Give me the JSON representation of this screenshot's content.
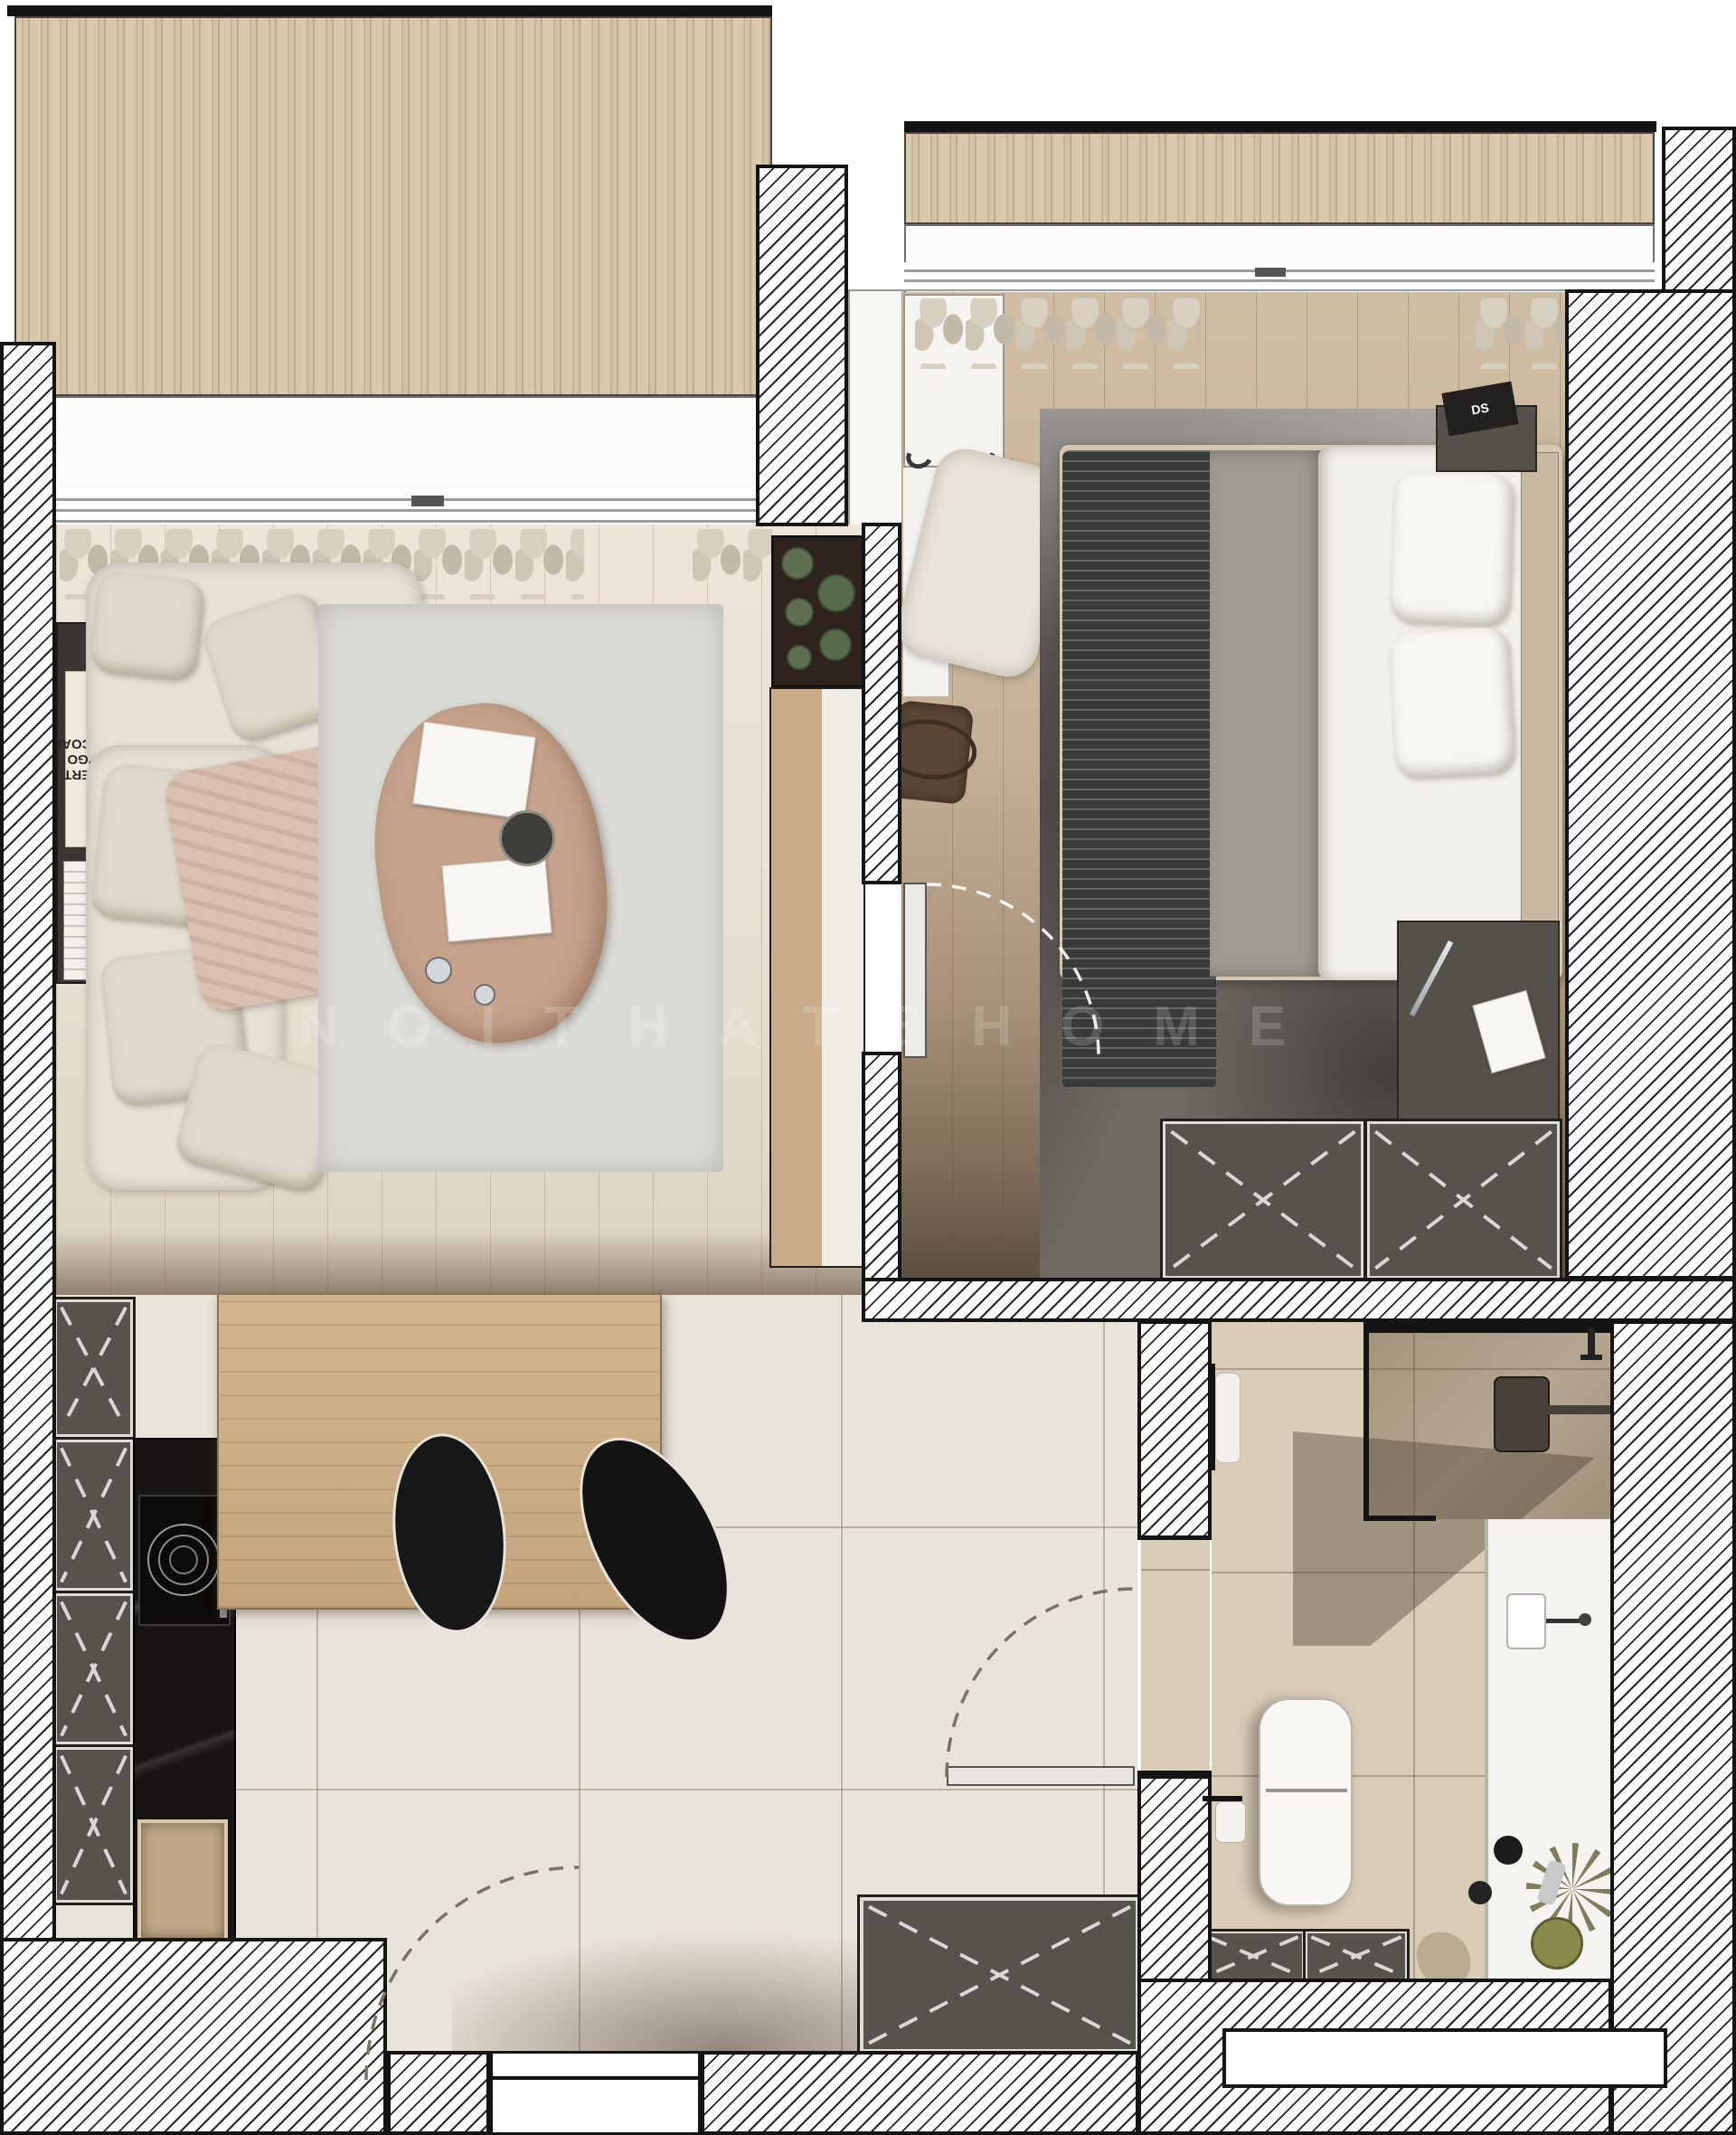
{
  "meta": {
    "type": "floor-plan-render",
    "view": "top-down apartment plan"
  },
  "watermark": {
    "text": "NOITHATSHOME"
  },
  "texts": {
    "book_spine": "ROBERT\nLONGO\nCHARCOAL",
    "nightstand_book": "DS"
  },
  "palette": {
    "wall_hatch_line": "#262626",
    "deck_wood": "#d4c2a7",
    "living_floor": "#e8e1d4",
    "bedroom_floor": "#c4b196",
    "tile_floor": "#e9e4da",
    "bath_tile": "#d9cdb8",
    "cabinet_gray": "#56524c",
    "counter_black": "#181514",
    "table_wood": "#ccae87",
    "sofa_cream": "#e7e0d4",
    "throw_pink": "#d9c0b0",
    "bed_throw_dark": "#3b3e3b",
    "bed_blanket_gray": "#a09c93",
    "bed_sheet_white": "#f2f0ec",
    "rug_living": "#dcdcd7",
    "rug_bedroom": "#6e6962",
    "chair_black": "#171717",
    "cactus_green": "#5f7052"
  },
  "rooms": {
    "balcony": {
      "label": "balcony",
      "items": [
        "wood slat decking",
        "sliding windows"
      ]
    },
    "living_room": {
      "label": "living room",
      "items": [
        "corner sofa",
        "cushions",
        "throw blanket",
        "area rug",
        "coffee table",
        "magazines",
        "coffee cups",
        "wall shelf with books",
        "media cabinet",
        "cactus planter",
        "curtains"
      ]
    },
    "bedroom": {
      "label": "bedroom",
      "items": [
        "double bed",
        "white pillows",
        "gray blanket",
        "dark zigzag throw",
        "distressed rug",
        "armchair",
        "white wardrobe",
        "nightstand with book",
        "desk with pen and paper",
        "duffel bag",
        "fitted wardrobes",
        "curtains",
        "glass door"
      ]
    },
    "kitchen": {
      "label": "kitchen",
      "items": [
        "tall cabinets",
        "black stone counter",
        "induction hob",
        "sink",
        "dining table",
        "two black chairs"
      ]
    },
    "hallway": {
      "label": "hallway",
      "items": [
        "built-in wardrobe",
        "entrance door"
      ]
    },
    "bathroom": {
      "label": "bathroom",
      "items": [
        "walk-in shower",
        "shower head",
        "towel rail",
        "vanity counter",
        "washbasin",
        "toilet",
        "storage drawers",
        "toilet paper holder",
        "plant",
        "cosmetics"
      ]
    }
  }
}
